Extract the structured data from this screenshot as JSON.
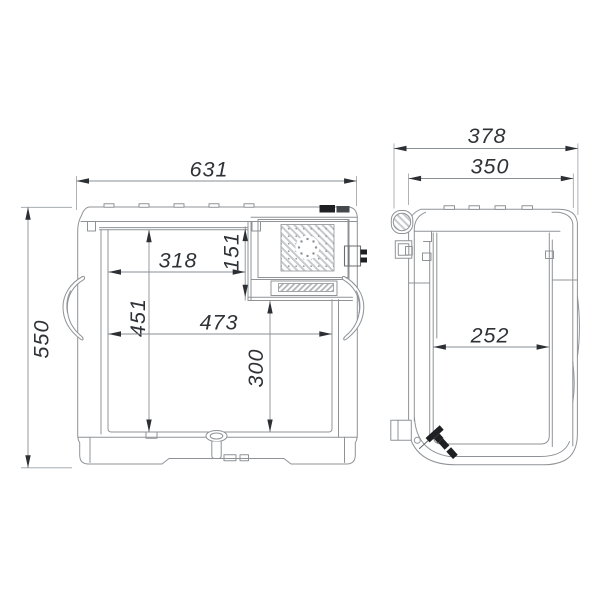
{
  "drawing": {
    "type": "two-view technical dimension drawing of portable compressor cooler",
    "colors": {
      "background": "#ffffff",
      "outline": "#8f9397",
      "dimension_line": "#8a8f93",
      "dimension_text": "#2f3236",
      "dark_fill": "#1e2023"
    },
    "front_view": {
      "name": "front view",
      "dimensions": [
        {
          "name": "overall_width",
          "value": "631"
        },
        {
          "name": "overall_height",
          "value": "550"
        },
        {
          "name": "inner_top_width",
          "value": "318"
        },
        {
          "name": "compressor_bay_height",
          "value": "151"
        },
        {
          "name": "inner_height",
          "value": "451"
        },
        {
          "name": "inner_full_width",
          "value": "473"
        },
        {
          "name": "inner_lower_height",
          "value": "300"
        }
      ]
    },
    "side_view": {
      "name": "side view",
      "dimensions": [
        {
          "name": "overall_depth",
          "value": "378"
        },
        {
          "name": "body_depth",
          "value": "350"
        },
        {
          "name": "inner_depth",
          "value": "252"
        }
      ]
    }
  }
}
